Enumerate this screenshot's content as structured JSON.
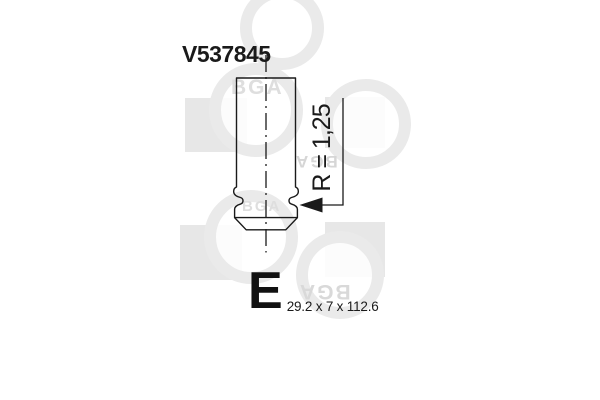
{
  "product": {
    "part_number": "V537845",
    "radius_annotation": "R = 1,25",
    "valve_letter": "E",
    "dimensions_label": "29.2 x 7 x 112.6"
  },
  "watermark": {
    "brand": "BGA"
  },
  "colors": {
    "line": "#1a1a1a",
    "text": "#1a1a1a",
    "watermark_square": "#e7e7e7",
    "watermark_ring": "#eaeaea",
    "watermark_text": "#dedede",
    "background": "#ffffff"
  }
}
